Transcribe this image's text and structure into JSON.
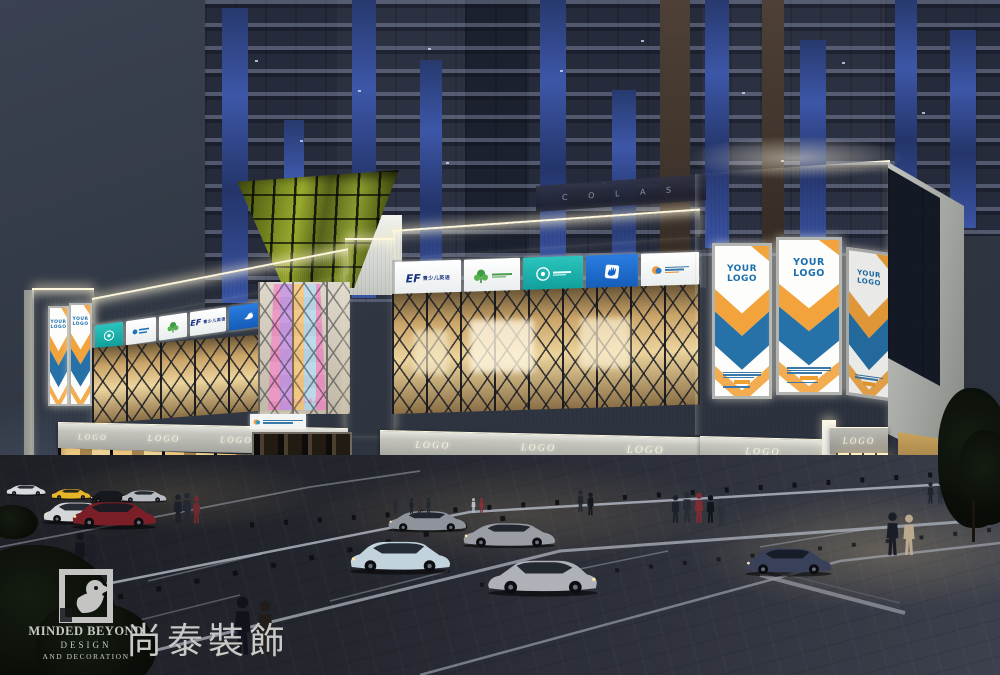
{
  "signs": {
    "your_logo_banner": "YOUR LOGO",
    "storefront_fascia": "LOGO",
    "ef_brand": "EF",
    "ef_tagline": "青少儿英语",
    "rooftop_faint_text": "C O L A S",
    "atrium_column_text": "JOY-PLAZA",
    "left_band_tiles": [
      "emblem-badge",
      "blue-wordmark",
      "green-tree",
      "ef-english",
      "blue-dove"
    ],
    "right_band_tiles": [
      "ef-english",
      "green-tree",
      "emblem-badge",
      "blue-hand",
      "multicolor-education"
    ]
  },
  "watermark": {
    "name_en": "MINDED BEYOND",
    "division_line1": "DESIGN",
    "division_line2": "AND DECORATION",
    "name_cn": "尚泰裝飾"
  },
  "palette": {
    "sky": "#2f3542",
    "tower_facade": "#262b3b",
    "tower_glass_blue": "#3d57a8",
    "mall_white": "#eceeea",
    "warm_interior": "#ffd98a",
    "teal_sign": "#17b3ae",
    "blue_sign": "#1565c8",
    "ef_blue": "#16317d",
    "banner_blue": "#2672a8",
    "banner_orange": "#f2a33c",
    "pavement": "#24262e",
    "watermark_gray": "#c8c8c6"
  }
}
